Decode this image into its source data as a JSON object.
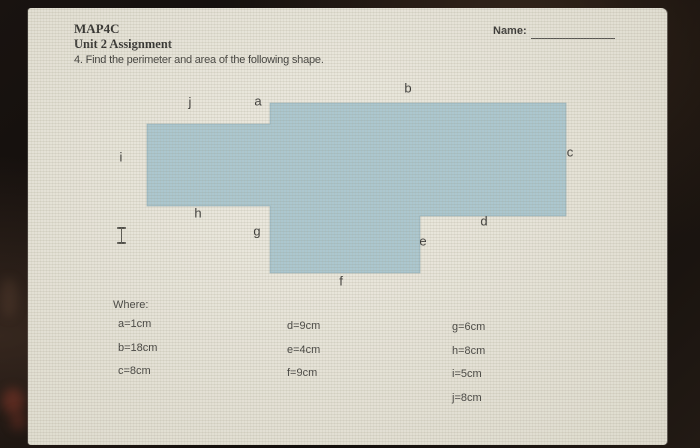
{
  "header": {
    "course_code": "MAP4C",
    "assignment_title": "Unit 2 Assignment",
    "question": "4. Find the perimeter and area of the following shape.",
    "name_label": "Name:"
  },
  "diagram": {
    "shape_fill": "#a7c4cd",
    "shape_stroke": "rgba(126,156,166,0.55)",
    "polygon_points": "242,95 538,95 538,208 392,208 392,265 242,265 242,198 119,198 119,116 242,116",
    "side_labels": [
      {
        "label": "a",
        "x": 230,
        "y": 93
      },
      {
        "label": "b",
        "x": 380,
        "y": 80
      },
      {
        "label": "c",
        "x": 542,
        "y": 144
      },
      {
        "label": "d",
        "x": 456,
        "y": 213
      },
      {
        "label": "e",
        "x": 395,
        "y": 233
      },
      {
        "label": "f",
        "x": 313,
        "y": 273
      },
      {
        "label": "g",
        "x": 229,
        "y": 223
      },
      {
        "label": "h",
        "x": 170,
        "y": 205
      },
      {
        "label": "i",
        "x": 93,
        "y": 149
      },
      {
        "label": "j",
        "x": 162,
        "y": 94
      }
    ]
  },
  "where": {
    "heading": "Where:",
    "columns": [
      {
        "x": 90,
        "y": 310,
        "items": [
          "a=1cm",
          "b=18cm",
          "c=8cm"
        ]
      },
      {
        "x": 259,
        "y": 312,
        "items": [
          "d=9cm",
          "e=4cm",
          "f=9cm"
        ]
      },
      {
        "x": 424,
        "y": 313,
        "items": [
          "g=6cm",
          "h=8cm",
          "i=5cm",
          "j=8cm"
        ]
      }
    ]
  }
}
